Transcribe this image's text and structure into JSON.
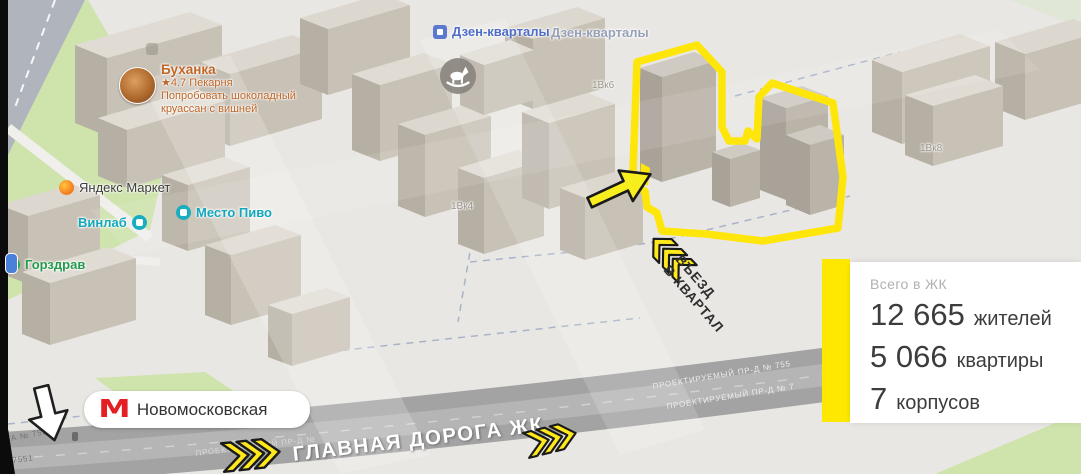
{
  "map": {
    "pois": {
      "bakery": {
        "name": "Буханка",
        "rating_line": "★4.7 Пекарня",
        "promo1": "Попробовать шоколадный",
        "promo2": "круассан с вишней"
      },
      "yandex_market": {
        "name": "Яндекс Маркет"
      },
      "vinlab": {
        "name": "Винлаб"
      },
      "mesto_pivo": {
        "name": "Место Пиво"
      },
      "gorzdrav": {
        "name": "Горздрав"
      },
      "dzen1": {
        "name": "Дзен-кварталы"
      },
      "dzen2": {
        "name": "Дзен-кварталы"
      }
    },
    "buildings": {
      "k6": "1Вк6",
      "k8": "1Вк8",
      "k4": "1Вк4"
    },
    "streets": {
      "projected1": "ПРОЕКТИРУЕМЫЙ ПР-Д № 755",
      "projected2": "ПРОЕКТИРУЕМЫЙ ПР-Д № 7",
      "projected_fragment": "ПРОЕКТИРУЕМЫЙ ПР-Д №",
      "road_a": "А № 7551",
      "road_b": "7551"
    },
    "metro": {
      "station": "Новомосковская",
      "logo": "М"
    },
    "annotations": {
      "entrance_line1": "ВЪЕЗД",
      "entrance_line2": "В КВАРТАЛ",
      "main_road_label": "ГЛАВНАЯ ДОРОГА ЖК"
    }
  },
  "stats_panel": {
    "title": "Всего в ЖК",
    "rows": [
      {
        "value": "12 665",
        "label": "жителей"
      },
      {
        "value": "5 066",
        "label": "квартиры"
      },
      {
        "value": "7",
        "label": "корпусов"
      }
    ]
  },
  "colors": {
    "highlight_yellow": "#ffe800",
    "metro_red": "#e31f24",
    "map_green": "#cfe3ad",
    "building_top": "#dfdbd3",
    "road_gray": "#a3a3a3"
  }
}
